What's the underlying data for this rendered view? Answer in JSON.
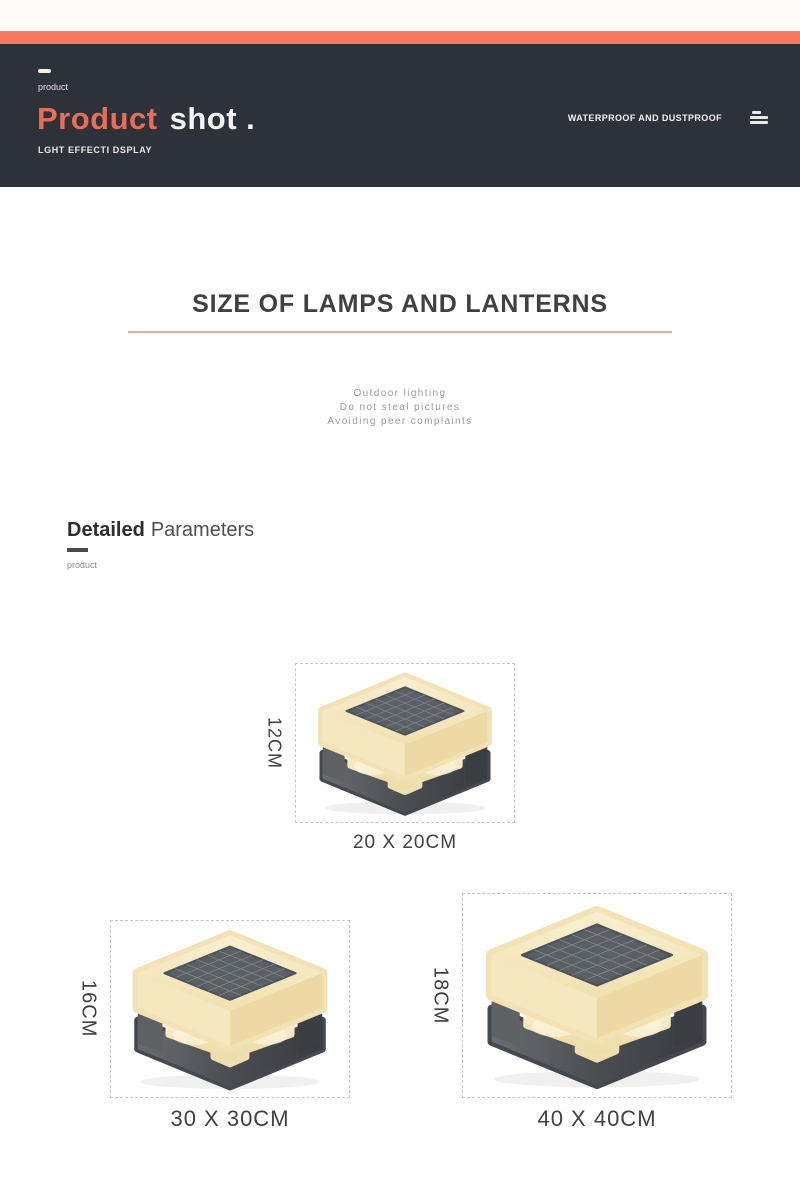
{
  "header": {
    "eyebrow": "product",
    "title_accent": "Product",
    "title_rest": "shot .",
    "subtitle": "LGHT EFFECTI DSPLAY",
    "right_label": "WATERPROOF AND DUSTPROOF",
    "menu_icon": "hamburger-menu"
  },
  "size_section": {
    "title": "SIZE OF LAMPS AND LANTERNS",
    "notes": [
      "Outdoor lighting",
      "Do not steal pictures",
      "Avoiding peer complaints"
    ]
  },
  "details_section": {
    "title_bold": "Detailed",
    "title_regular": "Parameters",
    "caption": "product"
  },
  "lamps": [
    {
      "height": "12CM",
      "footprint": "20 X 20CM"
    },
    {
      "height": "16CM",
      "footprint": "30 X 30CM"
    },
    {
      "height": "18CM",
      "footprint": "40 X 40CM"
    }
  ],
  "colors": {
    "accent_bar": "#f87a61",
    "header_bg": "#2d313a",
    "title_accent": "#e76e55",
    "heading_underline": "#d7a77c",
    "lamp_cream": "#f3e3b4",
    "lamp_base_dark": "#4a4d52",
    "lamp_glow": "#f7ecc9",
    "solar_panel": "#5a5f66"
  }
}
